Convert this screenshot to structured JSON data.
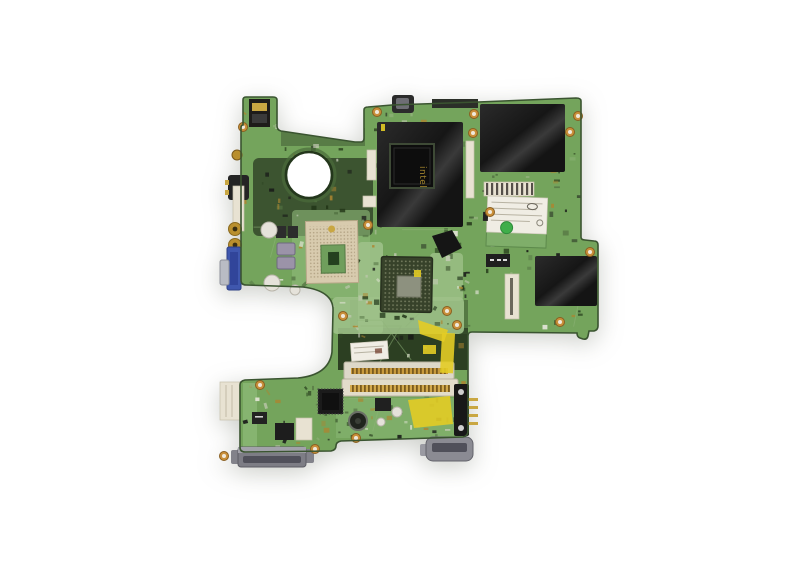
{
  "meta": {
    "domain": "Natural-Image",
    "subject": "Product photograph of a green laptop motherboard viewed from above, centered on a plain white background",
    "width": 800,
    "height": 563
  },
  "markings": {
    "northbridge_logo": "intel"
  },
  "colors": {
    "background": "#ffffff",
    "pcb": "#74a45c",
    "pcb_dark": "#3c5430",
    "pcb_darker": "#2c3f22",
    "pcb_light": "#9dc188",
    "pcb_light2": "#8fbb79",
    "board_edge": "#3a5430",
    "shield_black": "#191919",
    "chip_black": "#111111",
    "die_silver": "#8d917f",
    "gpu_pkg": "#37422a",
    "socket_beige": "#d8cbae",
    "socket_inner": "#6f9e5c",
    "vga_blue": "#3f57ae",
    "metal_silver": "#b9bcc4",
    "gold": "#c9a742",
    "copper": "#c98f3a",
    "kapton": "#e3cc25",
    "label_white": "#f0ede4",
    "connector_cream": "#e8e2d2",
    "connector_gray": "#82828a",
    "connector_gray_dark": "#50505a",
    "cap_purple": "#9b93a8",
    "green_dot": "#3fae4a"
  }
}
